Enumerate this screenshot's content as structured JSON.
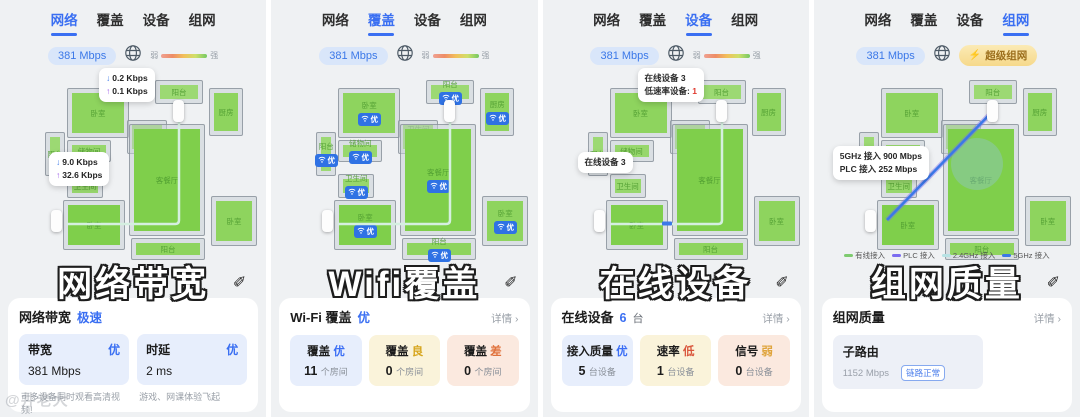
{
  "watermark": "@井老大",
  "tabs": [
    {
      "id": "network",
      "label": "网络"
    },
    {
      "id": "coverage",
      "label": "覆盖"
    },
    {
      "id": "devices",
      "label": "设备"
    },
    {
      "id": "mesh",
      "label": "组网"
    }
  ],
  "status": {
    "speed": "381 Mbps",
    "weak": "弱",
    "strong": "强",
    "mesh_badge": "超级组网"
  },
  "coverage_badge": "优",
  "rooms": [
    {
      "label": "卧室",
      "x": 52,
      "y": 14,
      "w": 62,
      "h": 50,
      "c": "#8ed45e"
    },
    {
      "label": "阳台",
      "x": 30,
      "y": 58,
      "w": 20,
      "h": 44,
      "c": "#9cd973"
    },
    {
      "label": "储物间",
      "x": 52,
      "y": 66,
      "w": 44,
      "h": 22,
      "c": "#97d76c"
    },
    {
      "label": "卫生间",
      "x": 112,
      "y": 46,
      "w": 40,
      "h": 34,
      "c": "#8ed45e"
    },
    {
      "label": "阳台",
      "x": 140,
      "y": 6,
      "w": 48,
      "h": 24,
      "c": "#9cd973"
    },
    {
      "label": "厨房",
      "x": 194,
      "y": 14,
      "w": 34,
      "h": 48,
      "c": "#8ed45e"
    },
    {
      "label": "客餐厅",
      "x": 114,
      "y": 50,
      "w": 76,
      "h": 112,
      "c": "#7fcf4b"
    },
    {
      "label": "卫生间",
      "x": 52,
      "y": 100,
      "w": 36,
      "h": 24,
      "c": "#97d76c"
    },
    {
      "label": "卧室",
      "x": 48,
      "y": 126,
      "w": 62,
      "h": 50,
      "c": "#7fcf4b"
    },
    {
      "label": "阳台",
      "x": 116,
      "y": 164,
      "w": 74,
      "h": 22,
      "c": "#8ed45e"
    },
    {
      "label": "卧室",
      "x": 196,
      "y": 122,
      "w": 46,
      "h": 50,
      "c": "#8ed45e"
    }
  ],
  "legend": [
    {
      "label": "有线接入",
      "color": "#7ecb6f"
    },
    {
      "label": "PLC 接入",
      "color": "#7b6cf0"
    },
    {
      "label": "2.4GHz 接入",
      "color": "#b7e2e4"
    },
    {
      "label": "5GHz 接入",
      "color": "#3b78e8"
    }
  ],
  "panels": [
    {
      "id": "network",
      "active_tab": 0,
      "overlay_title": "网络带宽",
      "status_right": "gradient",
      "plan": "elbow",
      "tooltips": [
        {
          "x": 84,
          "y": -6,
          "lines": [
            {
              "icon": "down",
              "em": "0.2 Kbps",
              "emc": "#222"
            },
            {
              "icon": "up",
              "em": "0.1 Kbps",
              "emc": "#222"
            }
          ]
        },
        {
          "x": 34,
          "y": 78,
          "lines": [
            {
              "icon": "down",
              "em": "9.0 Kbps",
              "emc": "#222"
            },
            {
              "icon": "up",
              "em": "32.6 Kbps",
              "emc": "#222"
            }
          ]
        }
      ],
      "card": {
        "type": "bandwidth",
        "title": "网络带宽",
        "tag": "极速",
        "metrics": [
          {
            "label": "带宽",
            "grade": "优",
            "value": "381 Mbps",
            "caption": "可多设备同时观看高清视频!"
          },
          {
            "label": "时延",
            "grade": "优",
            "value": "2 ms",
            "caption": "游戏、网课体验飞起"
          }
        ]
      }
    },
    {
      "id": "coverage",
      "active_tab": 1,
      "overlay_title": "Wifi覆盖",
      "status_right": "gradient",
      "plan": "elbow",
      "room_badges": true,
      "tooltips": [],
      "card": {
        "type": "triple",
        "title": "Wi-Fi 覆盖",
        "title_tag": "优",
        "detail": "详情",
        "items": [
          {
            "label": "覆盖",
            "grade": "优",
            "gc": "#3b6ef5",
            "value": "11",
            "unit": "个房间",
            "bg": "#e7eefc"
          },
          {
            "label": "覆盖",
            "grade": "良",
            "gc": "#d6a51c",
            "value": "0",
            "unit": "个房间",
            "bg": "#faf3da"
          },
          {
            "label": "覆盖",
            "grade": "差",
            "gc": "#e0703a",
            "value": "0",
            "unit": "个房间",
            "bg": "#fbe9df"
          }
        ]
      }
    },
    {
      "id": "devices",
      "active_tab": 2,
      "overlay_title": "在线设备",
      "status_right": "gradient",
      "plan": "elbow-dev",
      "tooltips": [
        {
          "x": 80,
          "y": -6,
          "lines": [
            {
              "text": "在线设备 ",
              "em": "3",
              "emc": "#222"
            },
            {
              "text": "低速率设备: ",
              "em": "1",
              "emc": "#e03a2f"
            }
          ]
        },
        {
          "x": 20,
          "y": 78,
          "lines": [
            {
              "text": "在线设备 ",
              "em": "3",
              "emc": "#222"
            }
          ]
        }
      ],
      "card": {
        "type": "triple",
        "title": "在线设备",
        "title_tag": "6",
        "title_suffix": "台",
        "detail": "详情",
        "items": [
          {
            "label": "接入质量",
            "grade": "优",
            "gc": "#3b6ef5",
            "value": "5",
            "unit": "台设备",
            "bg": "#e7eefc"
          },
          {
            "label": "速率",
            "grade": "低",
            "gc": "#d9553b",
            "value": "1",
            "unit": "台设备",
            "bg": "#faf3da"
          },
          {
            "label": "信号",
            "grade": "弱",
            "gc": "#dfa43c",
            "value": "0",
            "unit": "台设备",
            "bg": "#fbe9df"
          }
        ]
      }
    },
    {
      "id": "mesh",
      "active_tab": 3,
      "overlay_title": "组网质量",
      "status_right": "mesh",
      "plan": "diag",
      "show_legend": true,
      "tooltips": [
        {
          "x": 4,
          "y": 72,
          "lines": [
            {
              "text": "5GHz 接入 ",
              "em": "900 Mbps",
              "emc": "#222"
            },
            {
              "text": "PLC 接入 ",
              "em": "252 Mbps",
              "emc": "#222"
            }
          ]
        }
      ],
      "card": {
        "type": "mesh",
        "title": "组网质量",
        "detail": "详情",
        "sub": {
          "name": "子路由",
          "speed": "1152 Mbps",
          "badge": "链路正常"
        }
      }
    }
  ]
}
